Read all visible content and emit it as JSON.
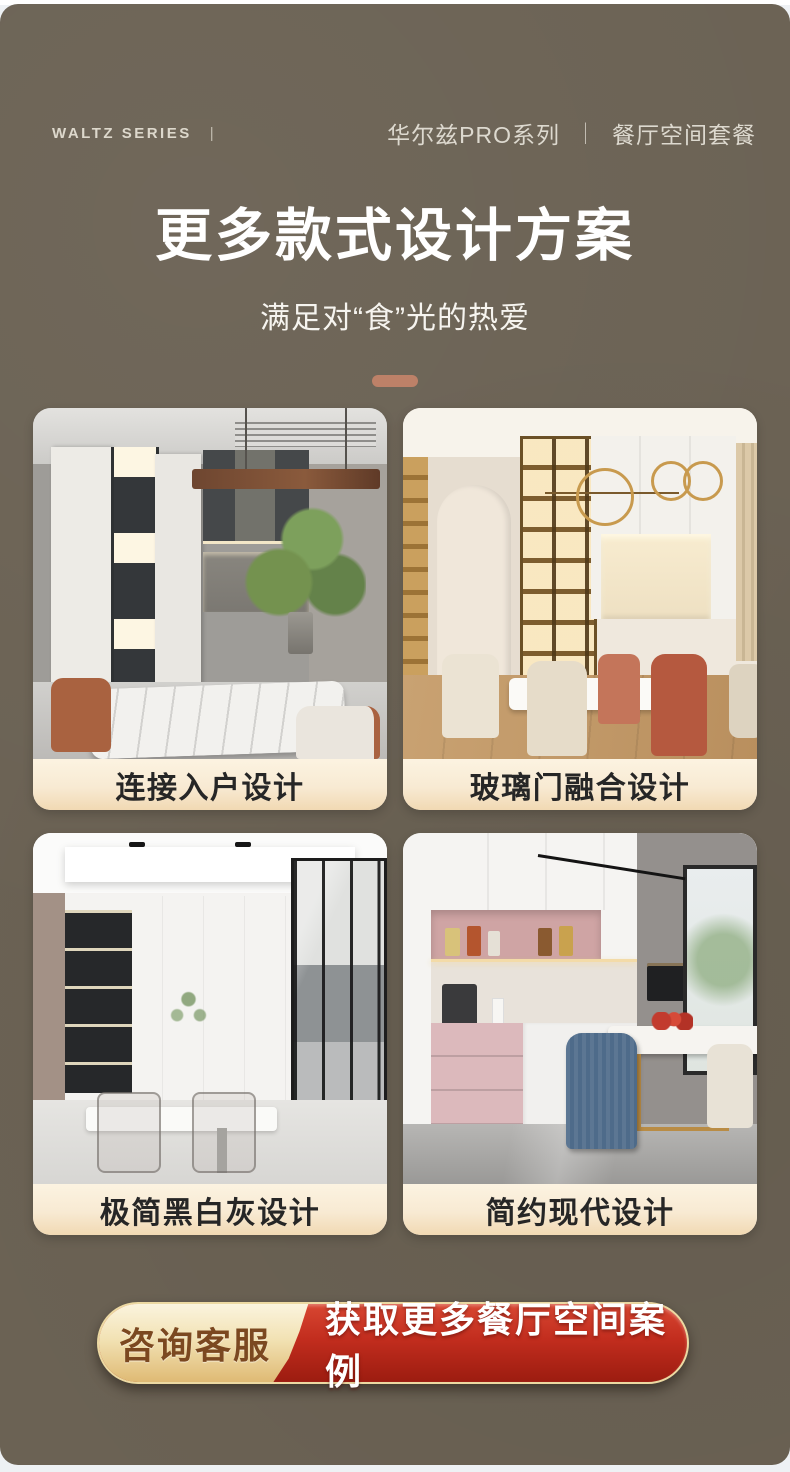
{
  "header": {
    "brand": "WALTZ SERIES",
    "brand_separator": "|",
    "series": "华尔兹PRO系列",
    "separator": "｜",
    "package": "餐厅空间套餐"
  },
  "hero": {
    "title": "更多款式设计方案",
    "subtitle": "满足对“食”光的热爱"
  },
  "cards": [
    {
      "caption": "连接入户设计",
      "photo": "grey-luxe-dining-room"
    },
    {
      "caption": "玻璃门融合设计",
      "photo": "cream-glass-door-dining-room"
    },
    {
      "caption": "极简黑白灰设计",
      "photo": "minimal-black-white-grey-dining"
    },
    {
      "caption": "简约现代设计",
      "photo": "simple-modern-pink-dining"
    }
  ],
  "cta": {
    "service_label": "咨询客服",
    "action_label": "获取更多餐厅空间案例"
  },
  "colors": {
    "panel_background": "#6b6254",
    "accent_pill": "#bd8168",
    "caption_gradient_top": "#fcf3e1",
    "caption_gradient_bottom": "#f1d9b3",
    "cta_gold_top": "#fbf4de",
    "cta_gold_bottom": "#dfba74",
    "cta_red_top": "#d84732",
    "cta_red_bottom": "#9c1c10",
    "cta_gold_text": "#7b4820",
    "cta_border": "#ecd9a2",
    "header_text": "#ddd9cf",
    "title_text": "#ffffff"
  }
}
